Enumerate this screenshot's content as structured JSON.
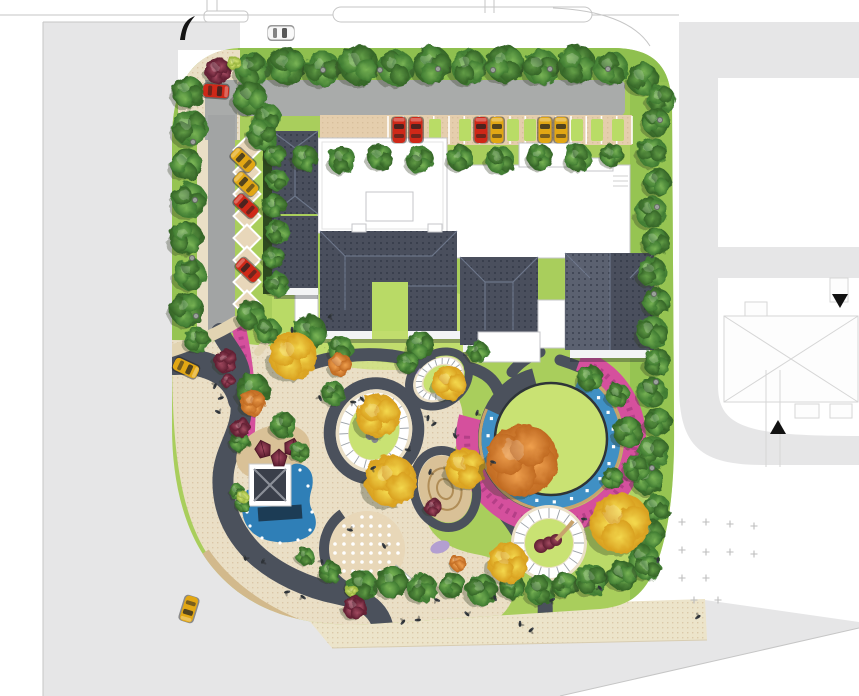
{
  "palette": {
    "street": "#e6e6e7",
    "street_line": "#c6c6c6",
    "outline_faint": "#d6d6d6",
    "asphalt": "#a9abaa",
    "driveway": "#a2a4a4",
    "path_dark": "#4b515c",
    "grass_band": "#8fc04f",
    "lawn": "#a9ce5c",
    "lawn_bright": "#c9e273",
    "court_green": "#b9da66",
    "plaza": "#eadfc6",
    "plaza_dot": "#cdb28d",
    "sidewalk": "#ece4ca",
    "bay": "#e5cead",
    "stall_green": "#b9dc66",
    "sand": "#d9c197",
    "tan": "#c8a36c",
    "pond": "#2f7fb7",
    "pond_dark": "#1c3c55",
    "water": "#4090c4",
    "pink": "#d5509d",
    "pink_dark": "#ab3b82",
    "lavender": "#b39fd1",
    "ring_line": "#9aa0a6",
    "roof_dark": "#4a4f5d",
    "roof_mid": "#5b6170",
    "roof_deep": "#394050",
    "car_red": "#cf2818",
    "car_yellow": "#e2a714",
    "car_white": "#f6f6f6",
    "car_darkred": "#8e2330",
    "cross": "#bdbdbd"
  },
  "scene": {
    "trees": {
      "green": [
        [
          252,
          70,
          17
        ],
        [
          287,
          66,
          19
        ],
        [
          323,
          69,
          18
        ],
        [
          359,
          65,
          20
        ],
        [
          396,
          68,
          18
        ],
        [
          432,
          65,
          19
        ],
        [
          469,
          67,
          18
        ],
        [
          505,
          64,
          19
        ],
        [
          541,
          67,
          18
        ],
        [
          577,
          64,
          19
        ],
        [
          611,
          68,
          17
        ],
        [
          643,
          79,
          16
        ],
        [
          661,
          99,
          14
        ],
        [
          656,
          122,
          14
        ],
        [
          652,
          152,
          15
        ],
        [
          657,
          182,
          14
        ],
        [
          651,
          212,
          16
        ],
        [
          656,
          242,
          14
        ],
        [
          652,
          272,
          15
        ],
        [
          657,
          302,
          14
        ],
        [
          652,
          332,
          16
        ],
        [
          657,
          362,
          14
        ],
        [
          652,
          392,
          15
        ],
        [
          658,
          422,
          14
        ],
        [
          653,
          452,
          16
        ],
        [
          648,
          480,
          15
        ],
        [
          656,
          508,
          14
        ],
        [
          650,
          534,
          15
        ],
        [
          644,
          560,
          16
        ],
        [
          188,
          92,
          16
        ],
        [
          190,
          128,
          18
        ],
        [
          186,
          164,
          16
        ],
        [
          189,
          200,
          18
        ],
        [
          186,
          238,
          17
        ],
        [
          190,
          274,
          16
        ],
        [
          187,
          310,
          17
        ],
        [
          197,
          340,
          13
        ],
        [
          250,
          98,
          17
        ],
        [
          268,
          118,
          14
        ],
        [
          305,
          158,
          13
        ],
        [
          342,
          160,
          14
        ],
        [
          380,
          157,
          13
        ],
        [
          420,
          160,
          14
        ],
        [
          460,
          158,
          13
        ],
        [
          500,
          160,
          14
        ],
        [
          540,
          157,
          13
        ],
        [
          578,
          158,
          14
        ],
        [
          612,
          155,
          12
        ],
        [
          262,
          135,
          15
        ],
        [
          275,
          155,
          11
        ],
        [
          277,
          180,
          11
        ],
        [
          274,
          206,
          12
        ],
        [
          278,
          232,
          12
        ],
        [
          274,
          258,
          11
        ],
        [
          277,
          284,
          12
        ],
        [
          251,
          315,
          15
        ],
        [
          268,
          331,
          13
        ],
        [
          253,
          390,
          17
        ],
        [
          283,
          425,
          13
        ],
        [
          240,
          442,
          10
        ],
        [
          300,
          452,
          10
        ],
        [
          310,
          332,
          17
        ],
        [
          340,
          348,
          13
        ],
        [
          420,
          345,
          14
        ],
        [
          478,
          352,
          11
        ],
        [
          408,
          363,
          11
        ],
        [
          333,
          393,
          12
        ],
        [
          590,
          378,
          13
        ],
        [
          618,
          395,
          12
        ],
        [
          628,
          432,
          15
        ],
        [
          636,
          468,
          13
        ],
        [
          612,
          478,
          11
        ],
        [
          237,
          492,
          8
        ],
        [
          243,
          505,
          7
        ],
        [
          362,
          585,
          15
        ],
        [
          392,
          582,
          16
        ],
        [
          422,
          588,
          15
        ],
        [
          452,
          585,
          13
        ],
        [
          482,
          590,
          16
        ],
        [
          512,
          586,
          13
        ],
        [
          540,
          590,
          15
        ],
        [
          565,
          585,
          13
        ],
        [
          592,
          580,
          16
        ],
        [
          622,
          575,
          15
        ],
        [
          648,
          568,
          13
        ],
        [
          330,
          572,
          11
        ],
        [
          305,
          556,
          9
        ]
      ],
      "yellow": [
        [
          293,
          356,
          24
        ],
        [
          378,
          416,
          22
        ],
        [
          449,
          383,
          17
        ],
        [
          391,
          481,
          26
        ],
        [
          465,
          468,
          20
        ],
        [
          620,
          523,
          30
        ],
        [
          508,
          563,
          20
        ]
      ],
      "orange": [
        [
          522,
          460,
          36
        ],
        [
          253,
          403,
          13
        ],
        [
          340,
          365,
          12
        ],
        [
          458,
          563,
          8
        ]
      ],
      "maroon": [
        [
          218,
          71,
          13
        ],
        [
          226,
          361,
          12
        ],
        [
          228,
          381,
          7
        ],
        [
          240,
          427,
          10
        ],
        [
          355,
          608,
          12
        ],
        [
          433,
          507,
          9
        ]
      ],
      "lime": [
        [
          234,
          63,
          7
        ],
        [
          243,
          497,
          6
        ],
        [
          352,
          591,
          6
        ]
      ]
    },
    "cars": [
      [
        281,
        33,
        90,
        "white"
      ],
      [
        216,
        91,
        94,
        "red"
      ],
      [
        399,
        130,
        0,
        "red"
      ],
      [
        416,
        130,
        0,
        "red"
      ],
      [
        481,
        130,
        0,
        "red"
      ],
      [
        497,
        130,
        0,
        "yellow"
      ],
      [
        545,
        130,
        0,
        "yellow"
      ],
      [
        561,
        130,
        0,
        "yellow"
      ],
      [
        243,
        160,
        -47,
        "yellow"
      ],
      [
        246,
        184,
        -47,
        "yellow"
      ],
      [
        246,
        206,
        -47,
        "red"
      ],
      [
        248,
        270,
        -47,
        "red"
      ],
      [
        186,
        368,
        115,
        "yellow"
      ],
      [
        189,
        609,
        197,
        "yellow"
      ]
    ],
    "people": [
      [
        292,
        330
      ],
      [
        330,
        316
      ],
      [
        353,
        402
      ],
      [
        362,
        399
      ],
      [
        428,
        418
      ],
      [
        434,
        424
      ],
      [
        408,
        450
      ],
      [
        455,
        436
      ],
      [
        477,
        413
      ],
      [
        373,
        468
      ],
      [
        493,
        462
      ],
      [
        320,
        398
      ],
      [
        215,
        386
      ],
      [
        221,
        398
      ],
      [
        218,
        412
      ],
      [
        245,
        558
      ],
      [
        263,
        561
      ],
      [
        287,
        592
      ],
      [
        303,
        597
      ],
      [
        322,
        562
      ],
      [
        403,
        622
      ],
      [
        418,
        620
      ],
      [
        467,
        614
      ],
      [
        520,
        624
      ],
      [
        531,
        630
      ],
      [
        584,
        519
      ],
      [
        600,
        588
      ],
      [
        658,
        560
      ],
      [
        698,
        617
      ],
      [
        350,
        530
      ],
      [
        384,
        546
      ],
      [
        430,
        472
      ],
      [
        552,
        600
      ],
      [
        437,
        600
      ],
      [
        495,
        598
      ]
    ],
    "lamps": [
      [
        323,
        70
      ],
      [
        380,
        70
      ],
      [
        438,
        69
      ],
      [
        493,
        70
      ],
      [
        550,
        69
      ],
      [
        608,
        69
      ],
      [
        193,
        142
      ],
      [
        195,
        200
      ],
      [
        192,
        258
      ],
      [
        196,
        316
      ],
      [
        660,
        120
      ],
      [
        657,
        207
      ],
      [
        654,
        294
      ],
      [
        656,
        382
      ],
      [
        652,
        468
      ]
    ],
    "paving_crosses": [
      [
        682,
        522
      ],
      [
        706,
        522
      ],
      [
        730,
        524
      ],
      [
        754,
        526
      ],
      [
        682,
        550
      ],
      [
        706,
        552
      ],
      [
        730,
        552
      ],
      [
        682,
        578
      ],
      [
        706,
        578
      ],
      [
        694,
        600
      ],
      [
        718,
        600
      ],
      [
        754,
        554
      ]
    ],
    "tents": [
      [
        263,
        449,
        -15
      ],
      [
        279,
        458,
        0
      ],
      [
        292,
        447,
        15
      ]
    ],
    "parking_bay": {
      "x0": 388,
      "x1": 632,
      "y": 116,
      "h": 28,
      "stall_lines": 16,
      "green_stalls": [
        435,
        465,
        513,
        530,
        577,
        597,
        618
      ]
    },
    "diag_stalls": {
      "cx": 247,
      "y0": 150,
      "pitch": 22,
      "count": 8,
      "size": 19
    },
    "oval": {
      "cx": 551,
      "cy": 439,
      "r": 56,
      "water_r": 63,
      "water_w": 13,
      "water_a0": -65,
      "water_a1": 205,
      "tan_r": 71,
      "pink_r": 84,
      "pink_w": 22,
      "pink_a0": -70,
      "pink_a1": 195
    },
    "planters": [
      {
        "cx": 374,
        "cy": 431,
        "rot": 15,
        "dark": [
          44,
          48,
          12
        ],
        "beige": [
          38,
          42
        ],
        "white": [
          30,
          34,
          9
        ],
        "lawn": [
          25,
          29
        ],
        "rock": true
      },
      {
        "cx": 439,
        "cy": 379,
        "rot": -35,
        "dark": [
          32,
          25,
          8
        ],
        "beige": [
          27,
          20
        ],
        "white": [
          22,
          16,
          6
        ],
        "lawn": [
          17,
          12
        ]
      },
      {
        "cx": 549,
        "cy": 543,
        "rot": 0,
        "beige": [
          38,
          38
        ],
        "white": [
          30,
          30,
          10
        ],
        "lawn": [
          24,
          24
        ],
        "sculpture": true
      }
    ],
    "sandhill": {
      "cx": 445,
      "cy": 489,
      "rx": 26,
      "ry": 34,
      "rot": -15
    },
    "dotted_circle": {
      "cx": 367,
      "cy": 549,
      "r": 38
    },
    "pond_dots": [
      [
        252,
        496
      ],
      [
        247,
        512
      ],
      [
        250,
        526
      ],
      [
        262,
        538
      ],
      [
        280,
        543
      ],
      [
        298,
        540
      ],
      [
        310,
        530
      ],
      [
        312,
        512
      ],
      [
        308,
        486
      ],
      [
        300,
        470
      ]
    ]
  }
}
